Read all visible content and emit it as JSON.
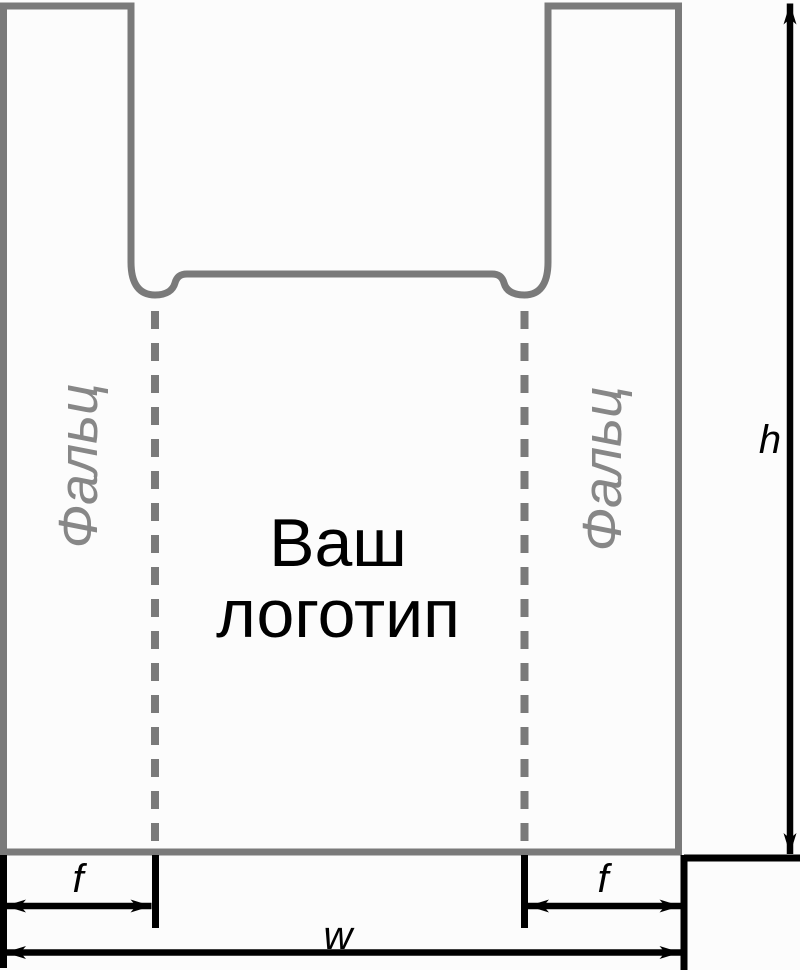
{
  "bag": {
    "logo_placeholder": {
      "line1": "Ваш",
      "line2": "логотип"
    },
    "fold_label_left": "Фальц",
    "fold_label_right": "Фальц"
  },
  "dimensions": {
    "height_label": "h",
    "width_label": "w",
    "fold_left_label": "f",
    "fold_right_label": "f"
  },
  "colors": {
    "bag_outline": "#7a7a7a",
    "fold_line": "#7a7a7a",
    "fold_text": "#878787",
    "logo_text": "#000000",
    "dimension_lines": "#000000",
    "background": "#fcfcfc"
  }
}
